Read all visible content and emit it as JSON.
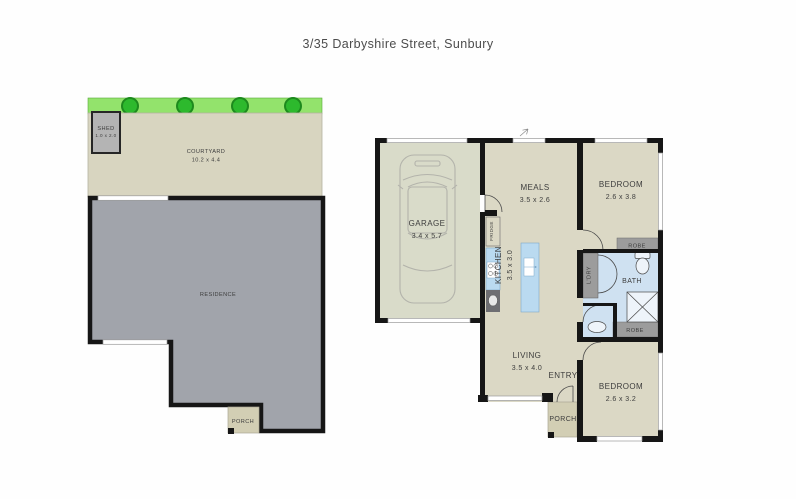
{
  "title": "3/35 Darbyshire Street, Sunbury",
  "site": {
    "shed_label": "SHED",
    "shed_dims": "1.0 x 2.0",
    "courtyard_label": "COURTYARD",
    "courtyard_dims": "10.2 x 4.4",
    "residence_label": "RESIDENCE",
    "porch_label": "PORCH",
    "tree_count": 4
  },
  "plan": {
    "garage_label": "GARAGE",
    "garage_dims": "3.4 x 5.7",
    "meals_label": "MEALS",
    "meals_dims": "3.5 x 2.6",
    "bedroom1_label": "BEDROOM",
    "bedroom1_dims": "2.6 x 3.8",
    "kitchen_label": "KITCHEN",
    "kitchen_dims": "3.5 x 3.0",
    "fridge_label": "FRIDGE",
    "laundry_label": "L'DRY",
    "bath_label": "BATH",
    "robe_top_label": "ROBE",
    "robe_bottom_label": "ROBE",
    "living_label": "LIVING",
    "living_dims": "3.5 x 4.0",
    "entry_label": "ENTRY",
    "porch_label": "PORCH",
    "bedroom2_label": "BEDROOM",
    "bedroom2_dims": "2.6 x 3.2"
  },
  "colors": {
    "floor_tan": "#dbd8c5",
    "garage_floor": "#d9dbc9",
    "courtyard_tan": "#d8d5c0",
    "porch_tan": "#d2ceb4",
    "residence_gray": "#a1a4ab",
    "wall_black": "#161616",
    "wet_area_blue": "#cfe1f1",
    "counter_blue": "#badaf0",
    "cabinet_gray": "#9c9c9c",
    "sink_dark": "#6e6e72",
    "lawn_green": "#93e36c",
    "tree_green": "#2db92d",
    "text_gray": "#3d3d3d"
  }
}
